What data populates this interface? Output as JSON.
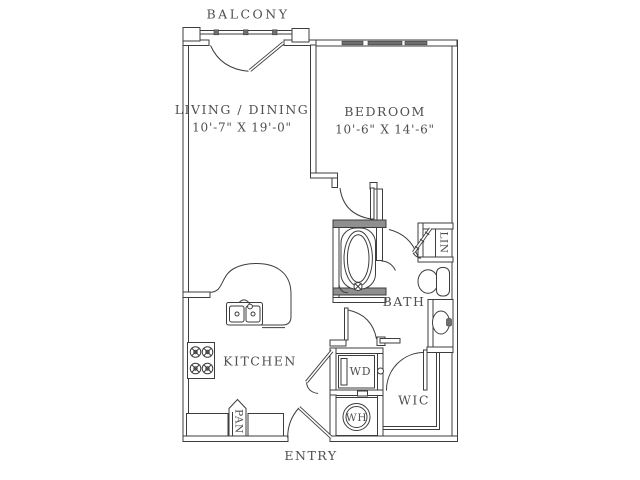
{
  "floor_plan": {
    "balcony": {
      "label": "BALCONY"
    },
    "rooms": {
      "living_dining": {
        "label": "LIVING / DINING",
        "dimensions": "10'-7\" X 19'-0\""
      },
      "bedroom": {
        "label": "BEDROOM",
        "dimensions": "10'-6\" X 14'-6\""
      },
      "kitchen": {
        "label": "KITCHEN"
      },
      "bath": {
        "label": "BATH"
      },
      "walk_in_closet": {
        "label": "WIC"
      },
      "entry": {
        "label": "ENTRY"
      }
    },
    "closets": {
      "pantry": "PAN",
      "linen": "LIN"
    },
    "appliances": {
      "washer_dryer": "WD",
      "water_heater": "WH"
    },
    "colors": {
      "background": "#ffffff",
      "line": "#3d3d3d",
      "text": "#4f4f4f",
      "wet_wall_fill": "#8f8f8f",
      "window_fill": "#6f6f6f"
    }
  }
}
